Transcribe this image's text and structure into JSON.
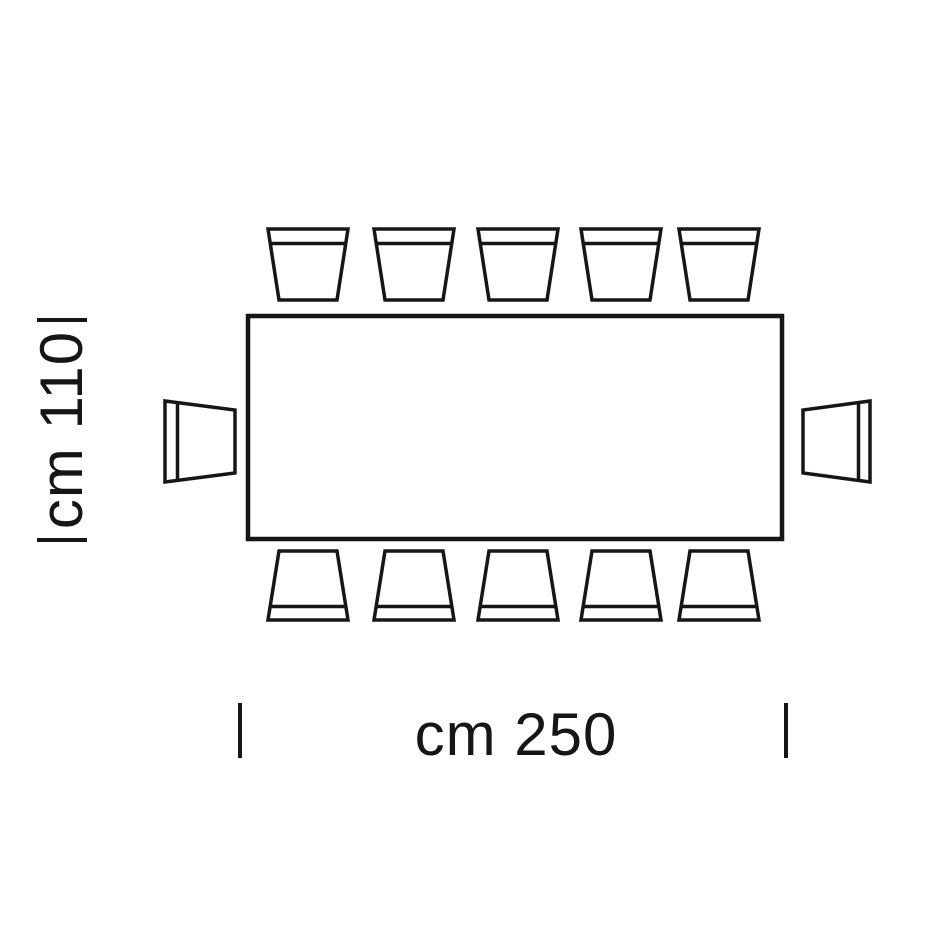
{
  "diagram": {
    "type": "furniture-dimension-plan-top-view",
    "width_label": "cm 250",
    "height_label": "cm 110",
    "line_color": "#161616",
    "background_color": "#ffffff",
    "table_shape": "rectangle",
    "seats_total": 12,
    "chairs_top": 5,
    "chairs_bottom": 5,
    "chairs_left": 1,
    "chairs_right": 1
  }
}
